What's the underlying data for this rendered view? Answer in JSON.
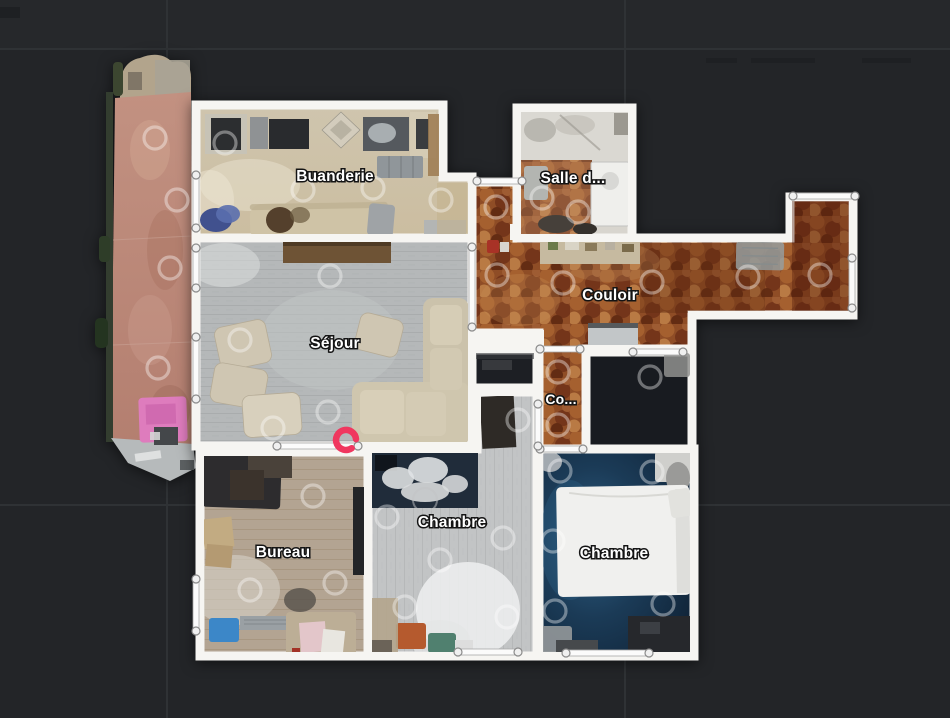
{
  "view": {
    "type": "floorplan-top-view"
  },
  "rooms": [
    {
      "id": "buanderie",
      "label": "Buanderie"
    },
    {
      "id": "salle-de-bain",
      "label": "Salle d..."
    },
    {
      "id": "couloir",
      "label": "Couloir"
    },
    {
      "id": "sejour",
      "label": "Séjour"
    },
    {
      "id": "couloir-2",
      "label": "Co..."
    },
    {
      "id": "bureau",
      "label": "Bureau"
    },
    {
      "id": "chambre-1",
      "label": "Chambre"
    },
    {
      "id": "chambre-2",
      "label": "Chambre"
    }
  ],
  "current_position": {
    "x": 346,
    "y": 440,
    "color": "#f0375f"
  },
  "scan_points": [
    [
      155,
      138
    ],
    [
      177,
      200
    ],
    [
      170,
      268
    ],
    [
      158,
      368
    ],
    [
      225,
      143
    ],
    [
      303,
      190
    ],
    [
      373,
      188
    ],
    [
      441,
      200
    ],
    [
      496,
      207
    ],
    [
      497,
      275
    ],
    [
      563,
      283
    ],
    [
      652,
      282
    ],
    [
      748,
      277
    ],
    [
      820,
      275
    ],
    [
      542,
      198
    ],
    [
      578,
      212
    ],
    [
      330,
      276
    ],
    [
      240,
      340
    ],
    [
      328,
      412
    ],
    [
      273,
      428
    ],
    [
      558,
      372
    ],
    [
      558,
      425
    ],
    [
      313,
      496
    ],
    [
      335,
      583
    ],
    [
      250,
      590
    ],
    [
      518,
      420
    ],
    [
      387,
      517
    ],
    [
      440,
      560
    ],
    [
      503,
      538
    ],
    [
      405,
      607
    ],
    [
      507,
      617
    ],
    [
      560,
      471
    ],
    [
      652,
      472
    ],
    [
      553,
      541
    ],
    [
      555,
      611
    ],
    [
      663,
      604
    ],
    [
      650,
      377
    ]
  ],
  "openings": [
    {
      "type": "window",
      "orient": "v",
      "x": 196,
      "y": 175,
      "len": 53
    },
    {
      "type": "door",
      "orient": "v",
      "x": 196,
      "y": 248,
      "len": 40
    },
    {
      "type": "door",
      "orient": "v",
      "x": 196,
      "y": 337,
      "len": 62
    },
    {
      "type": "door",
      "orient": "h",
      "x": 477,
      "y": 181,
      "len": 45
    },
    {
      "type": "door",
      "orient": "v",
      "x": 472,
      "y": 247,
      "len": 80
    },
    {
      "type": "door",
      "orient": "h",
      "x": 540,
      "y": 349,
      "len": 40
    },
    {
      "type": "door",
      "orient": "h",
      "x": 633,
      "y": 352,
      "len": 50
    },
    {
      "type": "window",
      "orient": "h",
      "x": 793,
      "y": 196,
      "len": 62
    },
    {
      "type": "window",
      "orient": "v",
      "x": 852,
      "y": 258,
      "len": 50
    },
    {
      "type": "door",
      "orient": "h",
      "x": 540,
      "y": 449,
      "len": 43
    },
    {
      "type": "door",
      "orient": "v",
      "x": 538,
      "y": 404,
      "len": 42
    },
    {
      "type": "opening",
      "orient": "h",
      "x": 277,
      "y": 446,
      "len": 81
    },
    {
      "type": "door",
      "orient": "h",
      "x": 458,
      "y": 652,
      "len": 60
    },
    {
      "type": "door",
      "orient": "h",
      "x": 566,
      "y": 653,
      "len": 83
    },
    {
      "type": "window",
      "orient": "v",
      "x": 196,
      "y": 579,
      "len": 52
    }
  ],
  "colors": {
    "background": "#232528",
    "background_top": "#26282b",
    "grid_line": "#2f3235",
    "wall": "#f6f5f2",
    "corridor_tile": "#8f4d26",
    "bedroom_floor_navy": "#16334d",
    "scan_ring": "rgba(255,255,255,0.38)"
  }
}
